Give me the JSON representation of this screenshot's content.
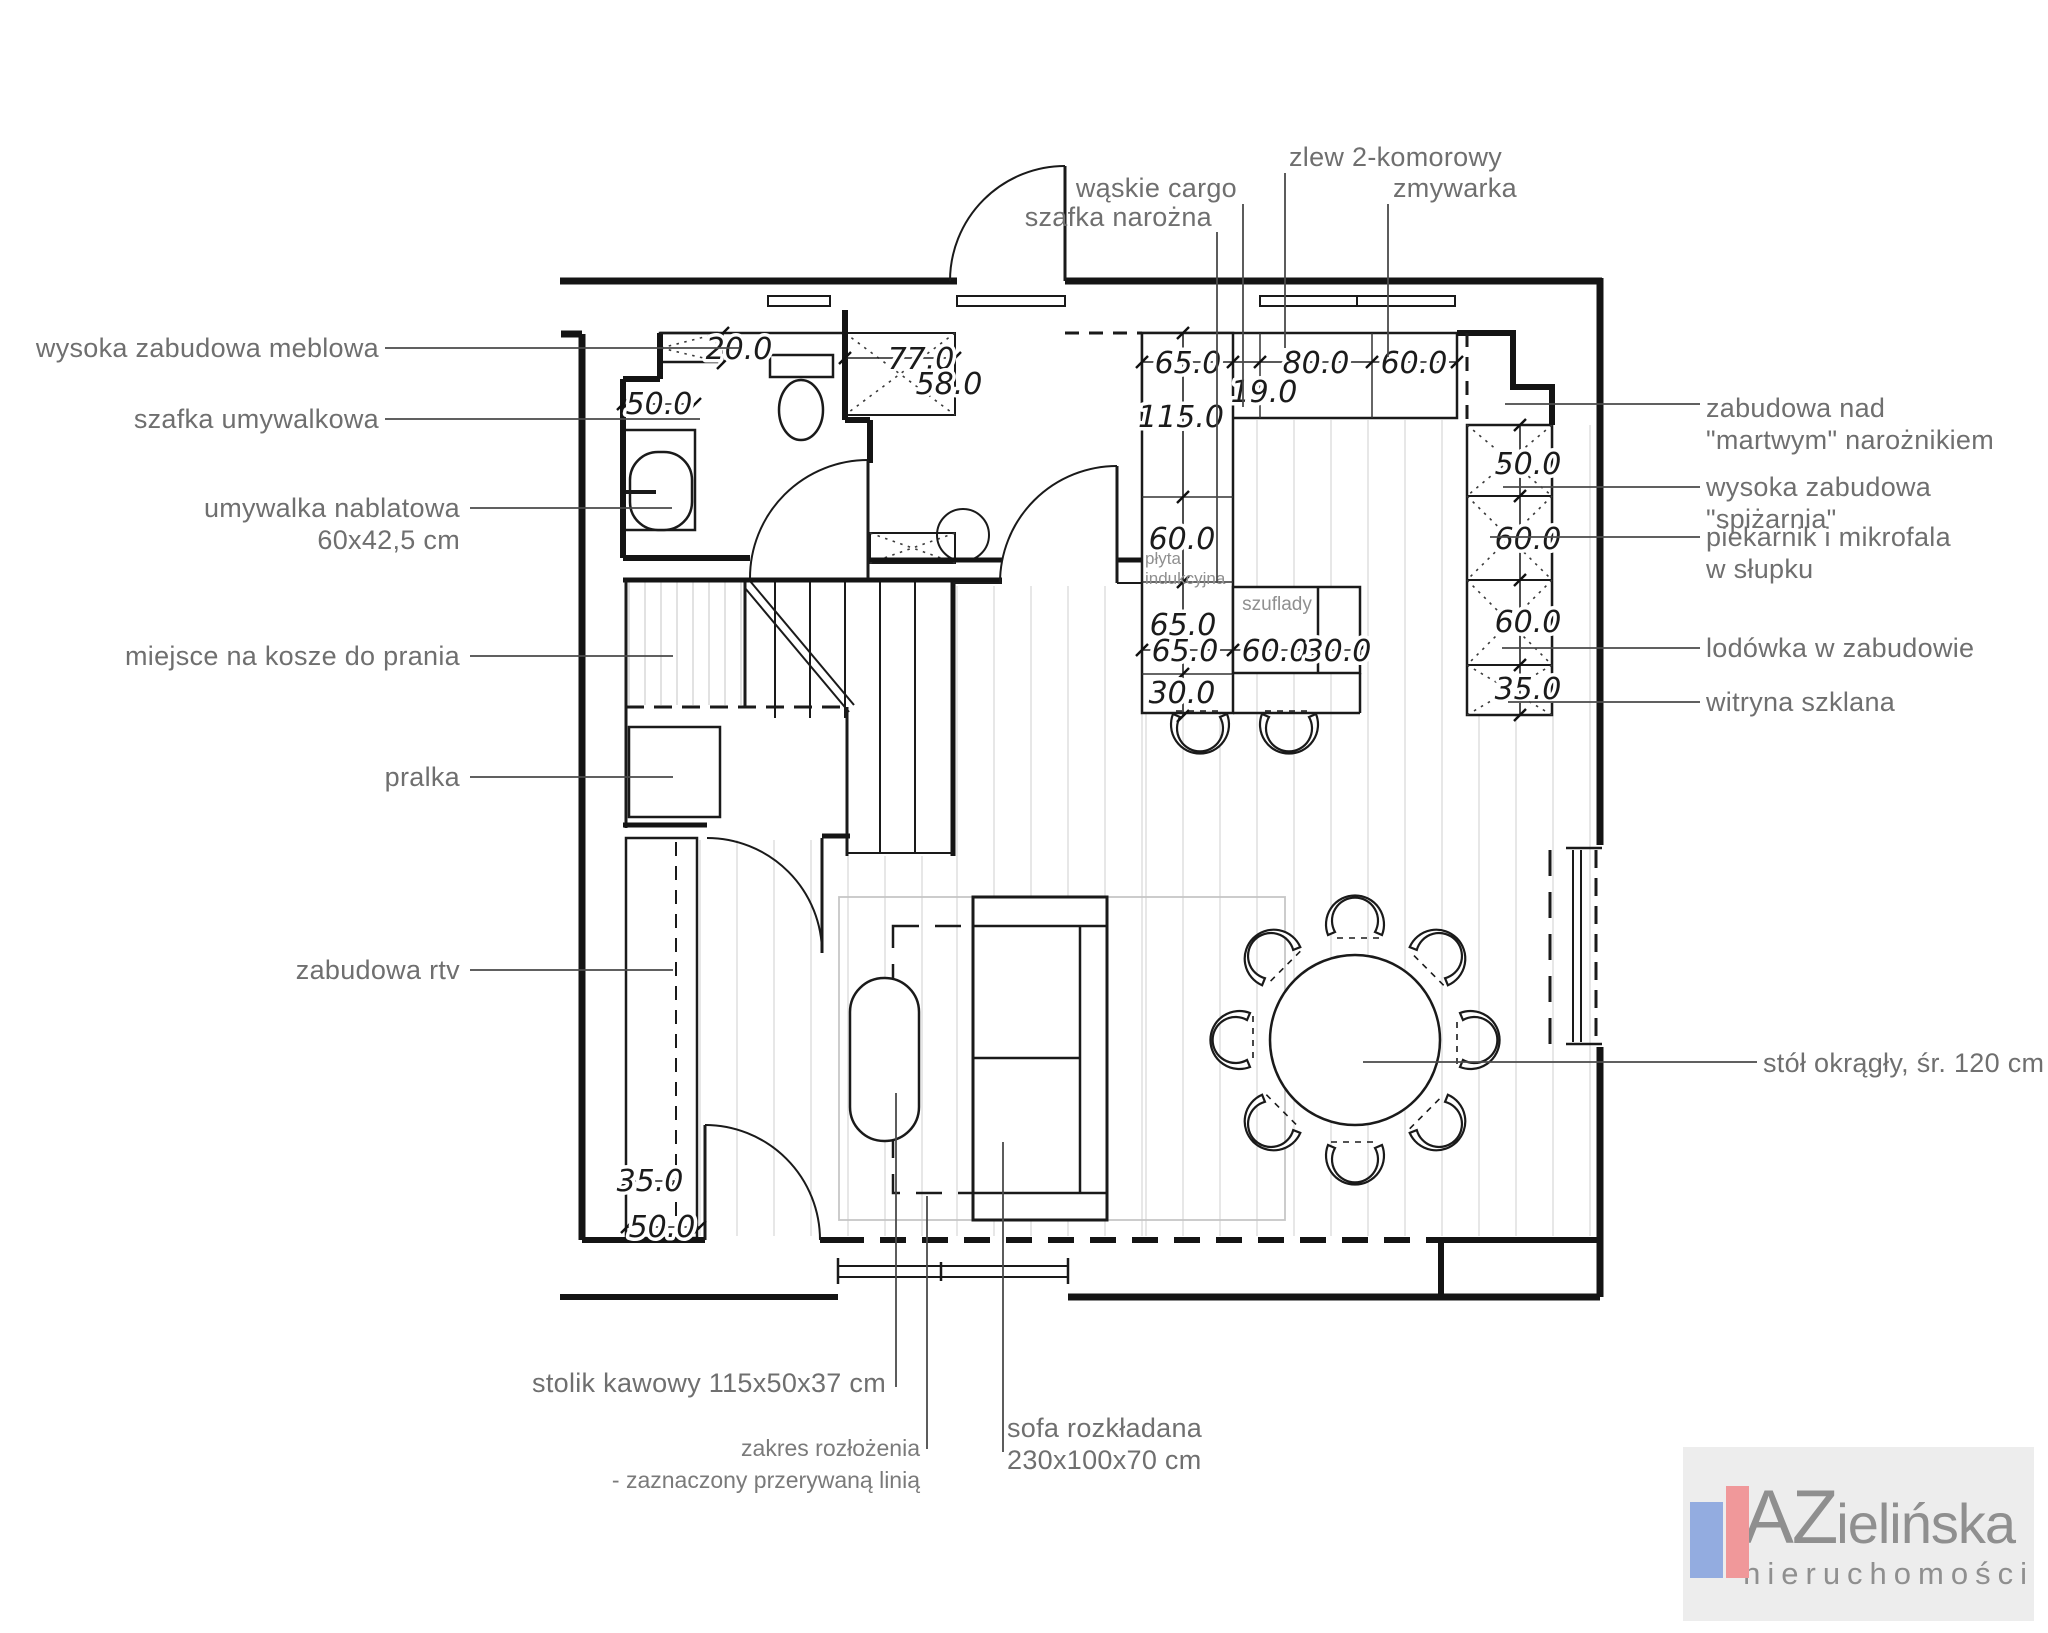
{
  "labels": {
    "wysoka_meblowa": "wysoka zabudowa meblowa",
    "szafka_umywalkowa": "szafka umywalkowa",
    "umywalka_1": "umywalka nablatowa",
    "umywalka_2": "60x42,5 cm",
    "kosze": "miejsce na kosze do prania",
    "pralka": "pralka",
    "rtv": "zabudowa rtv",
    "waskie_cargo": "wąskie cargo",
    "szafka_narozna": "szafka narożna",
    "zlew": "zlew 2-komorowy",
    "zmywarka": "zmywarka",
    "martwy_1": "zabudowa nad",
    "martwy_2": "\"martwym\" narożnikiem",
    "spizarnia_1": "wysoka zabudowa",
    "spizarnia_2": "\"spiżarnia\"",
    "piekarnik_1": "piekarnik i mikrofala",
    "piekarnik_2": "w słupku",
    "lodowka": "lodówka w zabudowie",
    "witryna": "witryna szklana",
    "stol": "stół okrągły, śr. 120 cm",
    "stolik": "stolik kawowy 115x50x37 cm",
    "zakres_1": "zakres rozłożenia",
    "zakres_2": "- zaznaczony przerywaną linią",
    "sofa_1": "sofa rozkładana",
    "sofa_2": "230x100x70 cm"
  },
  "dims": {
    "d20": "20.0",
    "d50": "50.0",
    "d77": "77.0",
    "d58": "58.0",
    "d65": "65.0",
    "d19": "19.0",
    "d80": "80.0",
    "d60": "60.0",
    "d115": "115.0",
    "d30": "30.0",
    "d35": "35.0"
  },
  "annotations": {
    "plyta_1": "płyta",
    "plyta_2": "indukcyjna",
    "szuflady": "szuflady"
  },
  "logo": {
    "az": "AZ",
    "rest": "ielińska",
    "subtitle": "nieruchomości"
  }
}
